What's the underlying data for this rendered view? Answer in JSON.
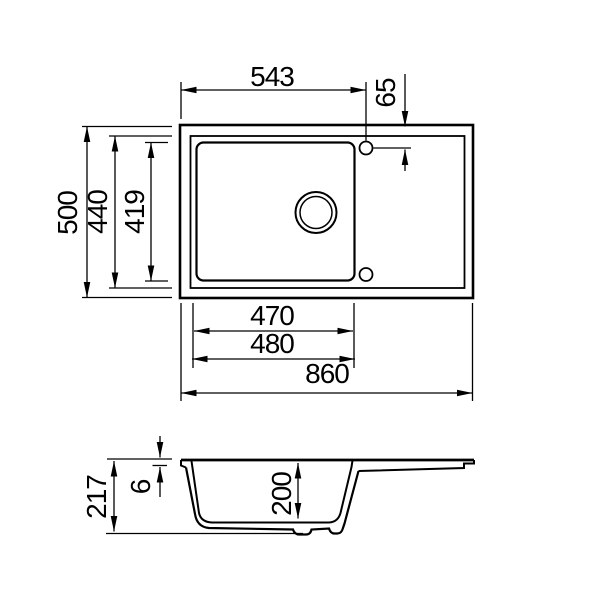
{
  "page": {
    "background": "#ffffff",
    "line_color": "#000000"
  },
  "drawing": {
    "type": "technical-dimension-drawing",
    "subject": "kitchen sink with single bowl and drainer, plan view and section view",
    "views": {
      "plan": {
        "dims": {
          "width_to_tap_hole": "543",
          "tap_hole_offset": "65",
          "overall_depth": "500",
          "inner_rim_depth": "440",
          "bowl_inner_depth": "419",
          "bowl_width_inner": "470",
          "bowl_width_outer": "480",
          "overall_width": "860"
        }
      },
      "section": {
        "dims": {
          "overall_height": "217",
          "rim_thickness": "6",
          "bowl_depth": "200"
        }
      }
    }
  }
}
